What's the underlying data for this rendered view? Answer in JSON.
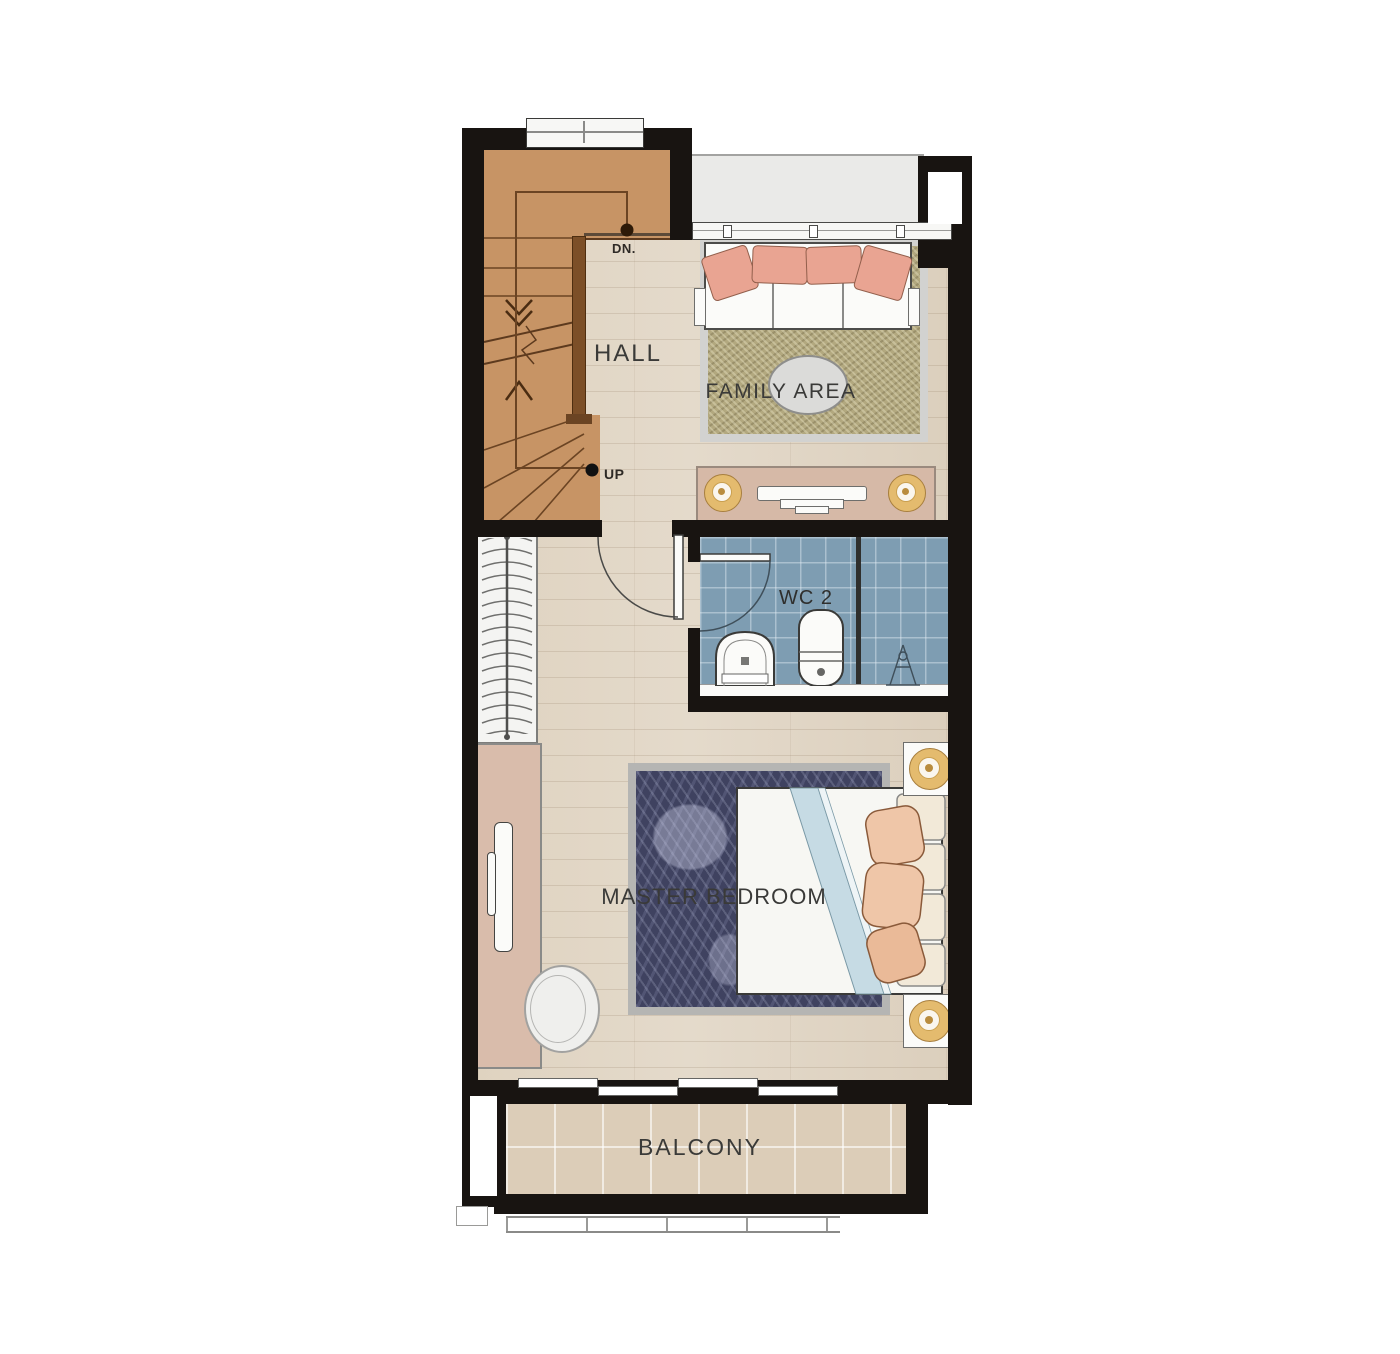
{
  "plan": {
    "title": "Upper floor plan",
    "rooms": {
      "hall": "HALL",
      "family_area": "FAMILY AREA",
      "wc": "WC 2",
      "master_bedroom": "MASTER BEDROOM",
      "balcony": "BALCONY"
    },
    "stairs": {
      "down": "DN.",
      "up": "UP"
    }
  },
  "colors": {
    "wall": "#181411",
    "stair": "#c79465",
    "stair-line": "#6b4423",
    "rail": "#7c4f28",
    "floor": "#e4dacb",
    "tile": "#7e9db2",
    "rug-olive": "#b2a87f",
    "rug-navy": "#3f4260",
    "balcony": "#dccdb8",
    "ledge": "#eaeae8",
    "sofa-pillow": "#e9a492",
    "bed-pillow": "#efc6a8",
    "bed-stripe": "#c6dbe4",
    "console": "#d6b9a7",
    "dresser": "#d9bcab",
    "gold": "#e4bb6e",
    "label": "#3a3a38"
  }
}
